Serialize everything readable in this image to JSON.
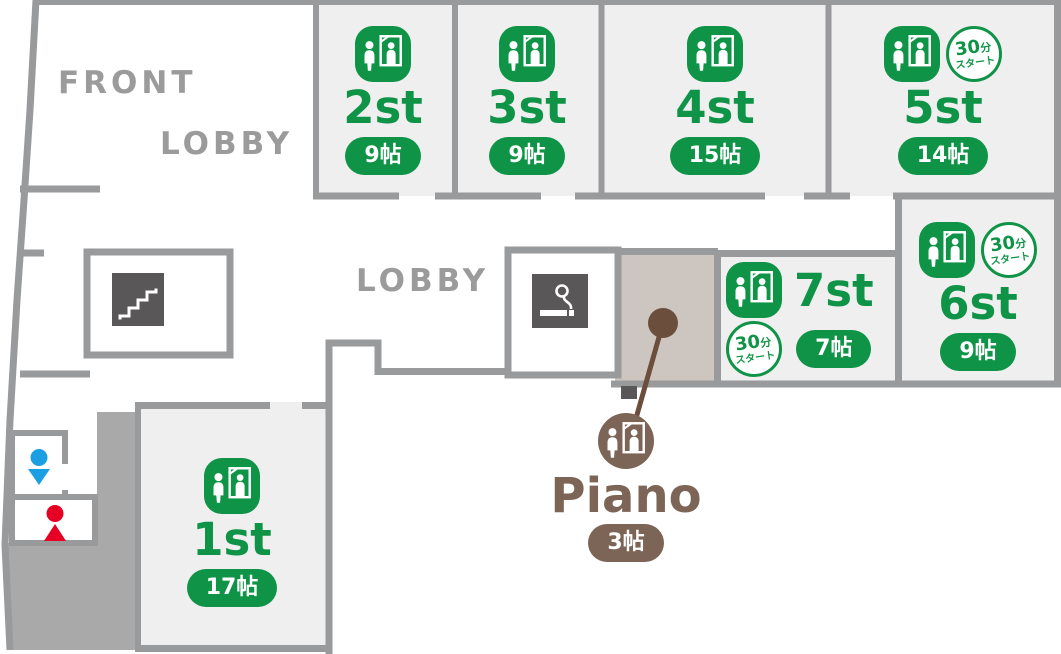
{
  "palette": {
    "green": "#0f9447",
    "brown": "#7c6557",
    "dark_brown": "#6b4e3c",
    "wall_gray": "#999a9b",
    "room_fill": "#efeff0",
    "piano_room_fill": "#cdc5bf",
    "filled_area_gray": "#a9a9aa",
    "dark_tile": "#595757",
    "label_gray": "#9b9b9b",
    "mens_blue": "#1b9fe3",
    "womens_red": "#e60023"
  },
  "area_labels": {
    "front": "FRONT",
    "lobby_top": "LOBBY",
    "lobby_mid": "LOBBY"
  },
  "thirty_badge": {
    "num": "30",
    "unit": "分",
    "bottom": "スタート"
  },
  "rooms": [
    {
      "id": "1st",
      "name": "1st",
      "size": "17帖",
      "color": "green",
      "thirty_min_start": false
    },
    {
      "id": "2st",
      "name": "2st",
      "size": "9帖",
      "color": "green",
      "thirty_min_start": false
    },
    {
      "id": "3st",
      "name": "3st",
      "size": "9帖",
      "color": "green",
      "thirty_min_start": false
    },
    {
      "id": "4st",
      "name": "4st",
      "size": "15帖",
      "color": "green",
      "thirty_min_start": false
    },
    {
      "id": "5st",
      "name": "5st",
      "size": "14帖",
      "color": "green",
      "thirty_min_start": true
    },
    {
      "id": "6st",
      "name": "6st",
      "size": "9帖",
      "color": "green",
      "thirty_min_start": true
    },
    {
      "id": "7st",
      "name": "7st",
      "size": "7帖",
      "color": "green",
      "thirty_min_start": true
    },
    {
      "id": "piano",
      "name": "Piano",
      "size": "3帖",
      "color": "brown",
      "thirty_min_start": false
    }
  ],
  "icons": {
    "studio": "person-with-mirror-studio-icon",
    "thirty_min": "30min-start-circle-badge",
    "smoking": "smoking-area-cigarette-icon",
    "stairs": "staircase-icon",
    "mens_toilet": "mens-toilet-marker",
    "womens_toilet": "womens-toilet-marker",
    "piano_marker": "piano-location-dot"
  }
}
